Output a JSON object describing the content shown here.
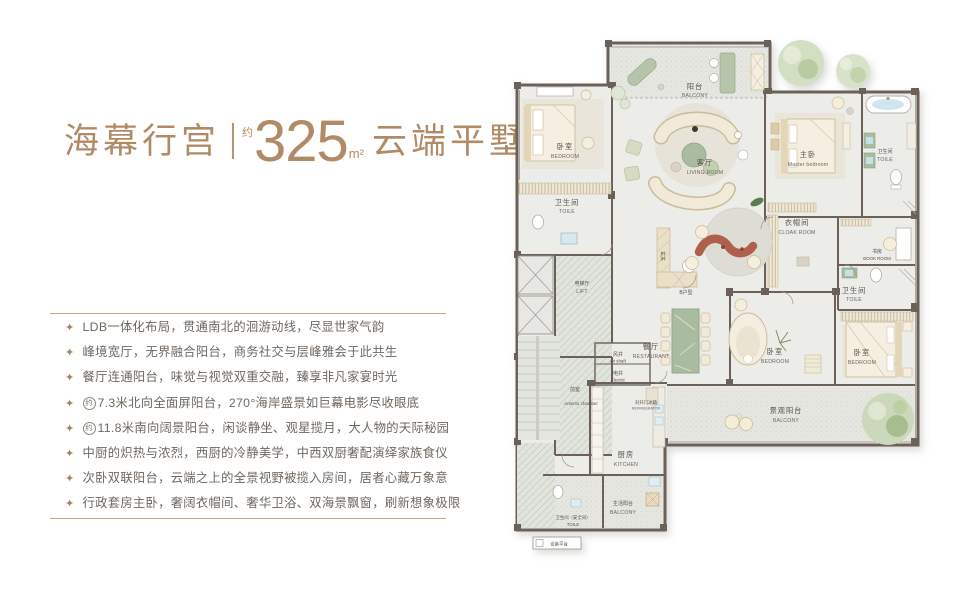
{
  "title": {
    "name": "海幕行宫",
    "area_prefix": "约",
    "area": "325",
    "area_unit": "m²",
    "suffix": "云端平墅"
  },
  "features": {
    "bullet_icon": "✦",
    "approx_glyph": "约",
    "items": [
      {
        "text": "LDB一体化布局，贯通南北的洄游动线，尽显世家气韵"
      },
      {
        "text": "峰境宽厅，无界融合阳台，商务社交与层峰雅会于此共生"
      },
      {
        "text": "餐厅连通阳台，味觉与视觉双重交融，臻享非凡家宴时光"
      },
      {
        "text": "7.3米北向全面屏阳台，270°海岸盛景如巨幕电影尽收眼底"
      },
      {
        "text": "11.8米南向阔景阳台，闲谈静坐、观星揽月，大人物的天际秘园"
      },
      {
        "text": "中厨的炽热与浓烈，西厨的冷静美学，中西双厨奢配演绎家族食仪"
      },
      {
        "text": "次卧双联阳台，云端之上的全景视野被揽入房间，居者心藏万象意"
      },
      {
        "text": "行政套房主卧，奢阔衣帽间、奢华卫浴、双海景飘窗，刷新想象极限"
      }
    ]
  },
  "floorplan": {
    "colors": {
      "accent": "#b18b66",
      "rule": "#c9a482",
      "text": "#6f6760",
      "wall": "#6b6158",
      "room_fill": "#ecece9",
      "balcony_fill": "#e6e6e1",
      "greenery": "#ccd8bb",
      "furniture_cream": "#f5efe1",
      "sculpture_red": "#ae604c"
    },
    "rooms": [
      {
        "id": "balcony-north",
        "cn": "阳台",
        "en": "BALCONY"
      },
      {
        "id": "living-room",
        "cn": "客厅",
        "en": "LIVING ROOM"
      },
      {
        "id": "bedroom-northwest",
        "cn": "卧室",
        "en": "BEDROOM"
      },
      {
        "id": "toilet-northwest",
        "cn": "卫生间",
        "en": "TOILE"
      },
      {
        "id": "master-bedroom",
        "cn": "主卧",
        "en": "Master bedroom"
      },
      {
        "id": "master-toilet",
        "cn": "卫生间",
        "en": "TOILE"
      },
      {
        "id": "cloak-room",
        "cn": "衣帽间",
        "en": "CLOAK ROOM"
      },
      {
        "id": "book-room",
        "cn": "书房",
        "en": "BOOK ROOM"
      },
      {
        "id": "toilet-east",
        "cn": "卫生间",
        "en": "TOILE"
      },
      {
        "id": "bedroom-southeast",
        "cn": "卧室",
        "en": "BEDROOM"
      },
      {
        "id": "bedroom-middle",
        "cn": "卧室",
        "en": "BEDROOM"
      },
      {
        "id": "view-balcony",
        "cn": "景观阳台",
        "en": "BALCONY"
      },
      {
        "id": "dining-room",
        "cn": "餐厅",
        "en": "RESTAURANT"
      },
      {
        "id": "entry",
        "cn": "玄关",
        "en": ""
      },
      {
        "id": "unit-b",
        "cn": "B户型",
        "en": ""
      },
      {
        "id": "lift-hall",
        "cn": "电梯厅",
        "en": "LIFT"
      },
      {
        "id": "air-shaft",
        "cn": "风井",
        "en": "air shaft"
      },
      {
        "id": "electric-well",
        "cn": "电井",
        "en": "Electric"
      },
      {
        "id": "anterior-chamber",
        "cn": "前室",
        "en": "Anterior chamber"
      },
      {
        "id": "kitchen",
        "cn": "厨房",
        "en": "KITCHEN"
      },
      {
        "id": "service-balcony",
        "cn": "生活阳台",
        "en": "BALCONY"
      },
      {
        "id": "toilet-safety",
        "cn": "卫生间（安全间）",
        "en": "TOILE"
      },
      {
        "id": "equipment-platform",
        "cn": "设备平台",
        "en": ""
      },
      {
        "id": "refrigerator",
        "cn": "对开门冰箱",
        "en": "REFRIGERATOR"
      }
    ]
  }
}
